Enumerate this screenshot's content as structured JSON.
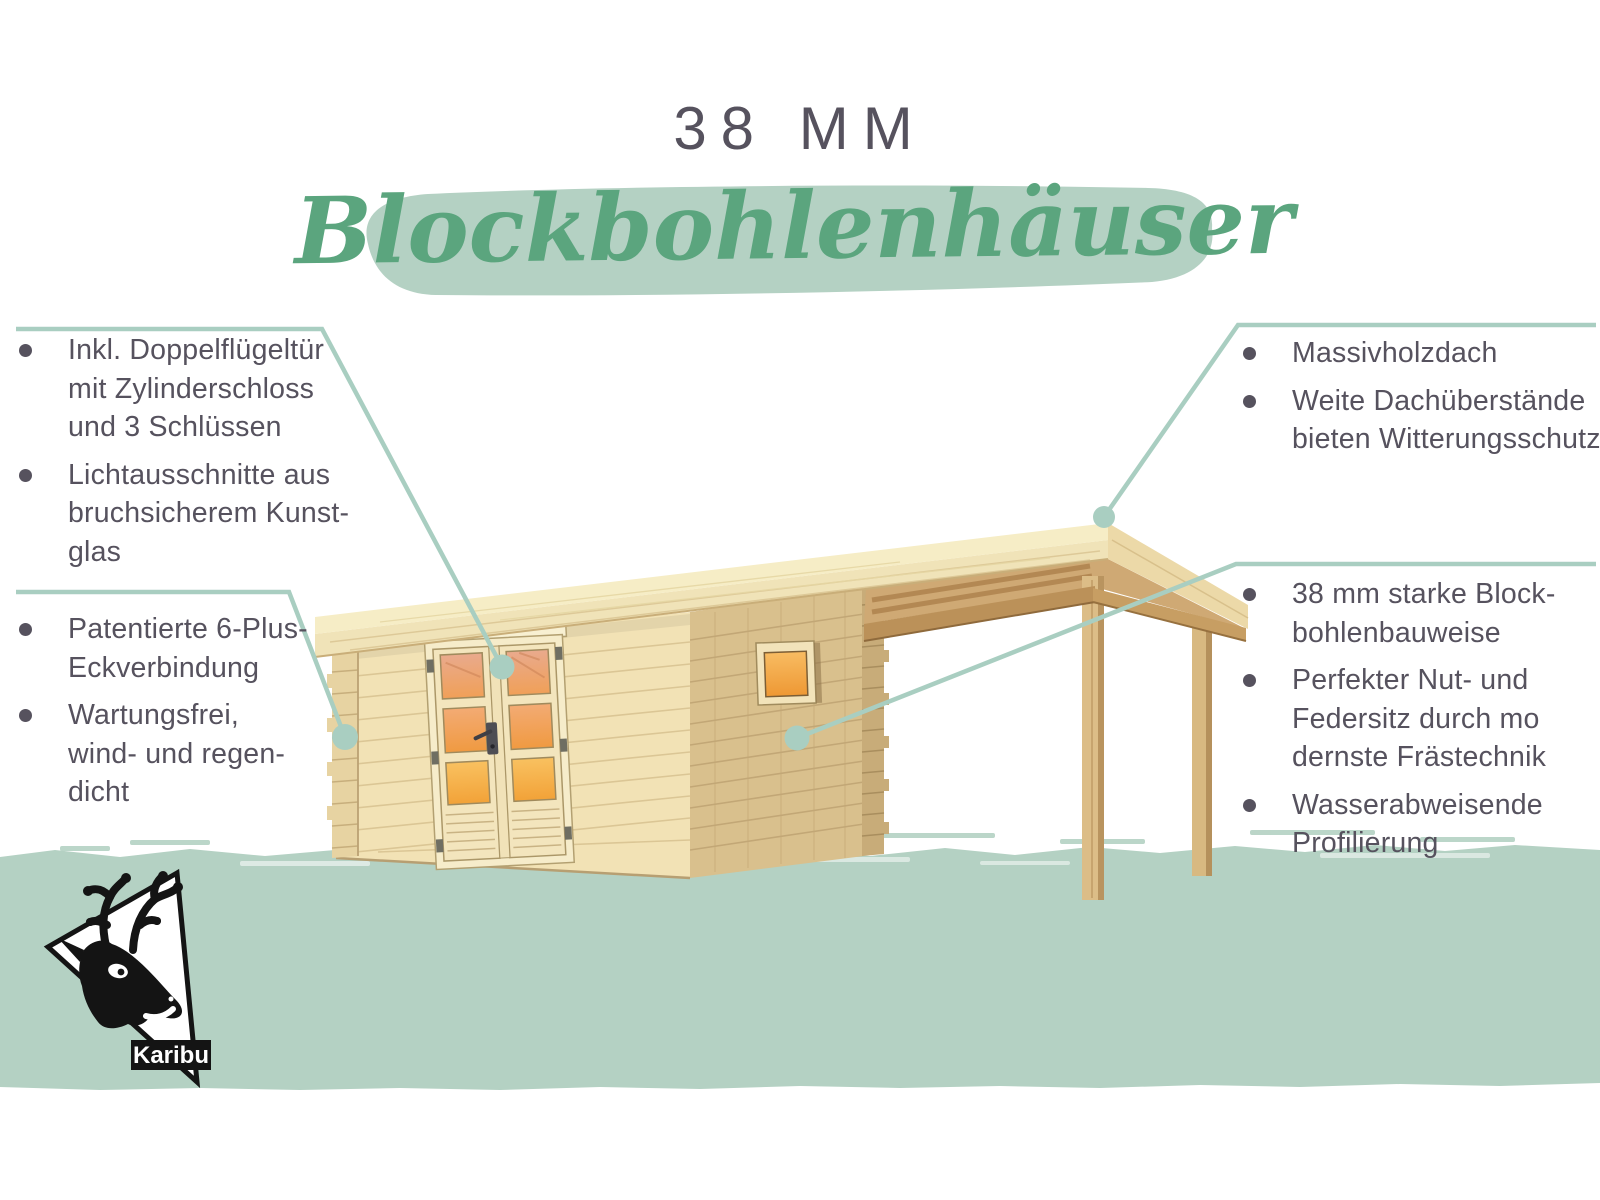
{
  "header": {
    "size_label": "38 MM",
    "script_title": "Blockbohlenhäuser"
  },
  "features": {
    "left": [
      {
        "lines": [
          "Inkl. Doppelflügeltür",
          "mit Zylinderschloss",
          "und 3 Schlüssen"
        ]
      },
      {
        "lines": [
          "Lichtausschnitte aus",
          "bruchsicherem Kunst-",
          "glas"
        ]
      },
      {
        "lines": [
          "Patentierte 6-Plus-",
          "Eckverbindung"
        ]
      },
      {
        "lines": [
          "Wartungsfrei,",
          "wind- und regen-",
          "dicht"
        ]
      }
    ],
    "right": [
      {
        "lines": [
          "Massivholzdach"
        ]
      },
      {
        "lines": [
          "Weite Dachüberstände",
          "bieten Witterungsschutz"
        ]
      },
      {
        "lines": [
          "38 mm starke Block-",
          "bohlenbauweise"
        ]
      },
      {
        "lines": [
          "Perfekter Nut- und",
          "Federsitz durch mo",
          "dernste Frästechnik"
        ]
      },
      {
        "lines": [
          "Wasserabweisende",
          "Profilierung"
        ]
      }
    ]
  },
  "logo": {
    "label": "Karibu"
  },
  "colors": {
    "accent_green": "#5ba57e",
    "sage_fill": "#b4d1c3",
    "callout_line": "#a9cec1",
    "text_color": "#56525e",
    "logo_black": "#141414",
    "wood_light": "#f2e2b5",
    "wood_shaded": "#d9c08d",
    "window_glow": "#f0a04a"
  }
}
